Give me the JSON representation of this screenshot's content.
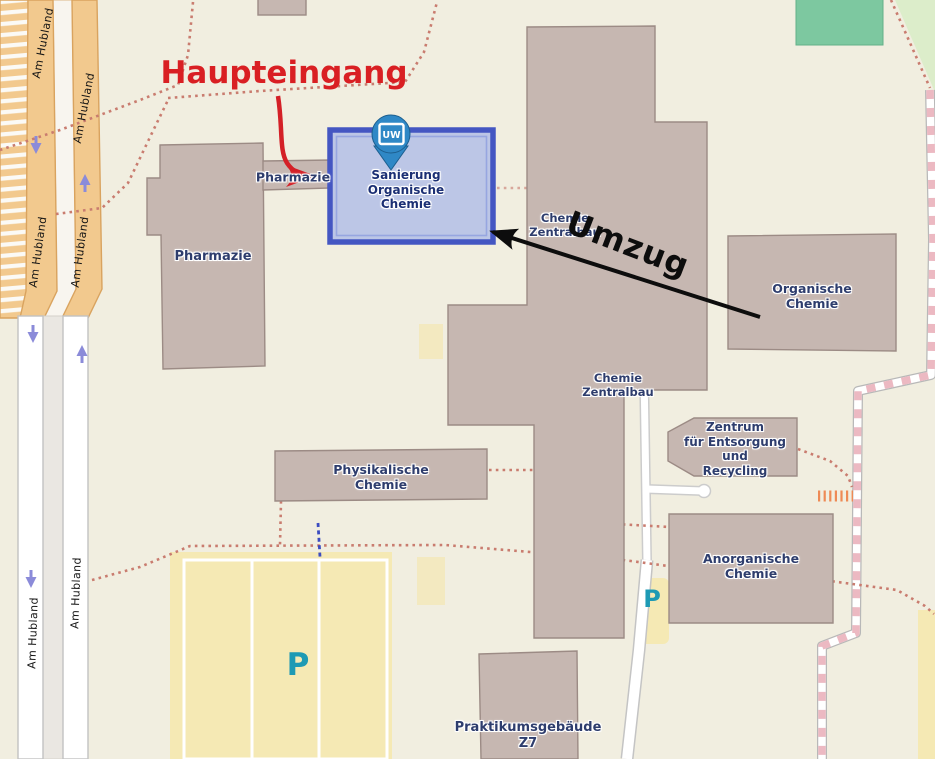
{
  "map": {
    "annotations": {
      "main_entrance": "Haupteingang",
      "relocation": "Umzug"
    },
    "marker": {
      "logo_text": "UW"
    },
    "streets": {
      "am_hubland": "Am Hubland"
    },
    "parking_symbol": "P",
    "buildings": [
      {
        "id": "sanierung-organische-chemie",
        "label": "Sanierung\nOrganische\nChemie",
        "highlighted": true
      },
      {
        "id": "pharmazie-corridor",
        "label": "Pharmazie"
      },
      {
        "id": "pharmazie",
        "label": "Pharmazie"
      },
      {
        "id": "chemie-zentralbau-upper",
        "label": "Chemie\nZentralbau"
      },
      {
        "id": "chemie-zentralbau-lower",
        "label": "Chemie\nZentralbau"
      },
      {
        "id": "organische-chemie",
        "label": "Organische\nChemie"
      },
      {
        "id": "physikalische-chemie",
        "label": "Physikalische\nChemie"
      },
      {
        "id": "zentrum-entsorgung-recycling",
        "label": "Zentrum\nfür Entsorgung\nund\nRecycling"
      },
      {
        "id": "anorganische-chemie",
        "label": "Anorganische\nChemie"
      },
      {
        "id": "praktikumsgebaeude-z7",
        "label": "Praktikumsgebäude\nZ7"
      }
    ],
    "colors": {
      "background": "#f1eee0",
      "building_fill": "#c6b7b1",
      "highlight_border": "#4456c2",
      "highlight_fill": "#bcc6e6",
      "annotation_red": "#d91f23",
      "marker_blue": "#2f88c6",
      "parking_yellow": "#f5e9b4",
      "parking_teal": "#1e9ab4",
      "road_orange": "#f2c98e",
      "footpath_red": "#c97c6f",
      "green_area": "#7dc8a0"
    }
  }
}
